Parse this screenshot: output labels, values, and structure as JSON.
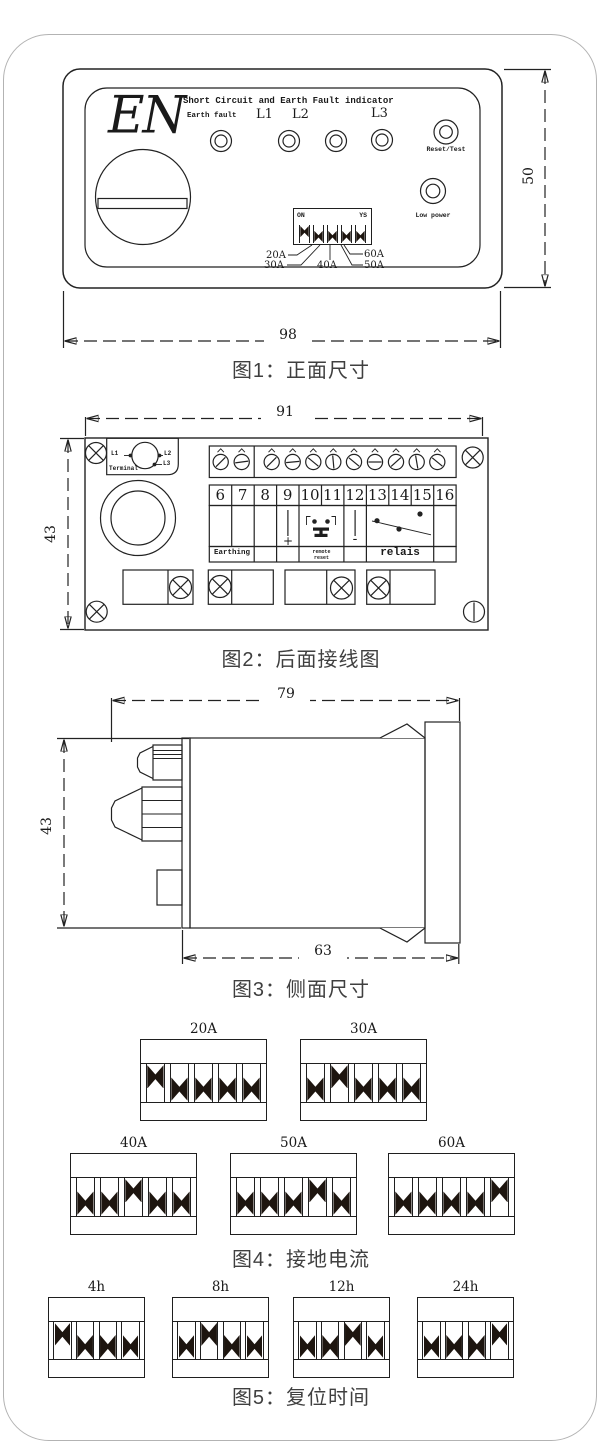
{
  "page": {
    "captions": {
      "fig1": "图1：正面尺寸",
      "fig2": "图2：后面接线图",
      "fig3": "图3：侧面尺寸",
      "fig4": "图4：接地电流",
      "fig5": "图5：复位时间"
    }
  },
  "fig1": {
    "brand": "EN",
    "title": "Short Circuit and Earth Fault indicator",
    "earth_fault": "Earth fault",
    "phases": [
      "L1",
      "L2",
      "L3"
    ],
    "reset_test": "Reset/Test",
    "low_power": "Low power",
    "dip_on": "ON",
    "dip_ys": "YS",
    "dip_switches": [
      1,
      0,
      0,
      0,
      0
    ],
    "current_taps": [
      "20A",
      "30A",
      "40A",
      "50A",
      "60A"
    ],
    "dim_width": "98",
    "dim_height": "50"
  },
  "fig2": {
    "dim_width": "91",
    "dim_height": "43",
    "terminal_label": "Terminal",
    "terminal_pins": [
      "L1",
      "L2",
      "L3"
    ],
    "terminal_numbers": [
      "6",
      "7",
      "8",
      "9",
      "10",
      "11",
      "12",
      "13",
      "14",
      "15",
      "16"
    ],
    "polarity_plus": "+",
    "polarity_minus": "-",
    "group_labels": {
      "earthing": "Earthing",
      "remote_line1": "remote",
      "remote_line2": "reset",
      "relais": "relais"
    }
  },
  "fig3": {
    "dim_top": "79",
    "dim_bottom": "63",
    "dim_height": "43"
  },
  "fig4": {
    "blocks": [
      {
        "label": "20A",
        "switches": [
          1,
          0,
          0,
          0,
          0
        ]
      },
      {
        "label": "30A",
        "switches": [
          0,
          1,
          0,
          0,
          0
        ]
      },
      {
        "label": "40A",
        "switches": [
          0,
          0,
          1,
          0,
          0
        ]
      },
      {
        "label": "50A",
        "switches": [
          0,
          0,
          0,
          1,
          0
        ]
      },
      {
        "label": "60A",
        "switches": [
          0,
          0,
          0,
          0,
          1
        ]
      }
    ]
  },
  "fig5": {
    "blocks": [
      {
        "label": "4h",
        "switches": [
          1,
          0,
          0,
          0
        ]
      },
      {
        "label": "8h",
        "switches": [
          0,
          1,
          0,
          0
        ]
      },
      {
        "label": "12h",
        "switches": [
          0,
          0,
          1,
          0
        ]
      },
      {
        "label": "24h",
        "switches": [
          0,
          0,
          0,
          1
        ]
      }
    ]
  }
}
